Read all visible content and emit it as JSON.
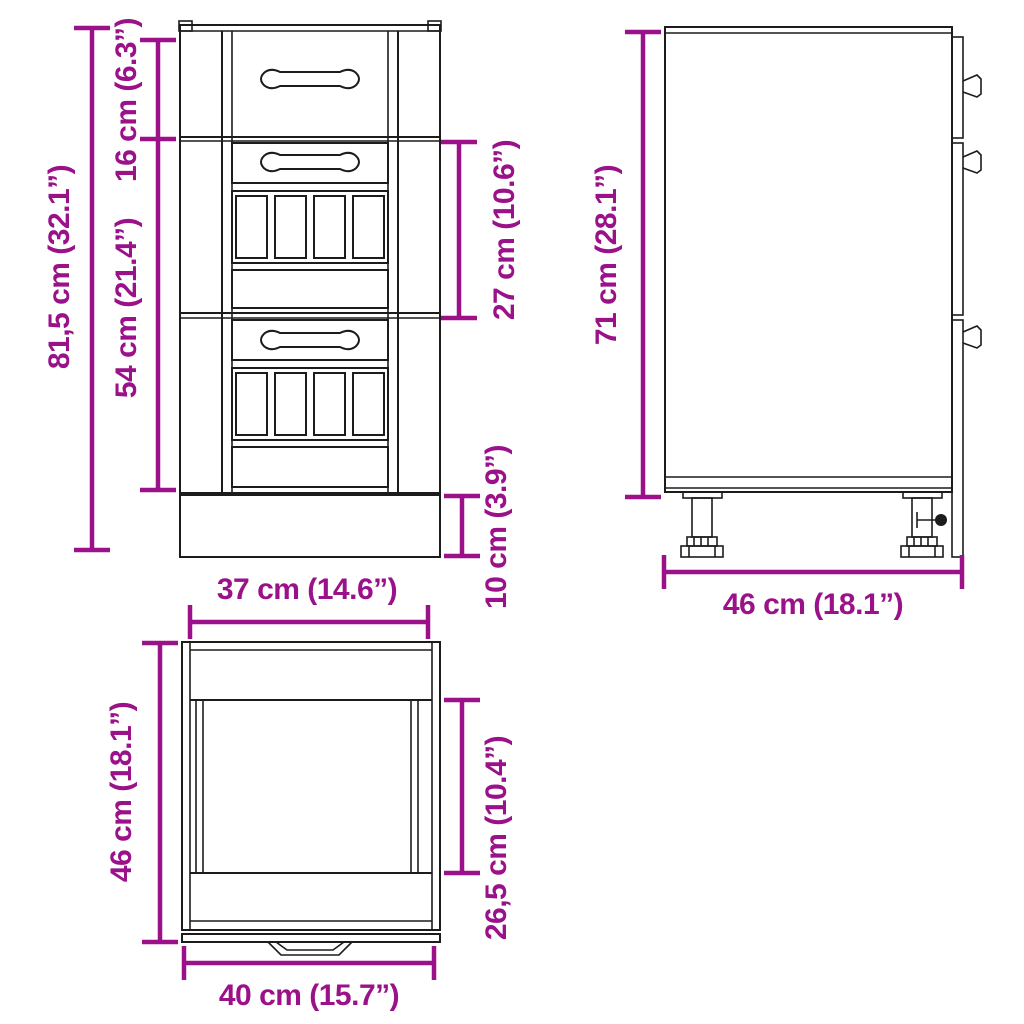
{
  "diagram": {
    "title": "Kitchen base cabinet dimension diagram",
    "colors": {
      "dimension": "#9a1189",
      "outline": "#1c1c1c",
      "background": "#ffffff"
    },
    "front_view": {
      "dim_total_height": "81,5 cm (32.1”)",
      "dim_top_drawer_height": "16 cm (6.3”)",
      "dim_drawer_stack_height": "54 cm (21.4”)",
      "dim_middle_section_height": "27 cm (10.6”)",
      "dim_plinth_height": "10 cm (3.9”)",
      "dim_front_width": "37 cm (14.6”)"
    },
    "side_view": {
      "dim_body_height": "71 cm (28.1”)",
      "dim_depth": "46 cm (18.1”)"
    },
    "top_view": {
      "dim_depth": "46 cm (18.1”)",
      "dim_inner_depth": "26,5 cm (10.4”)",
      "dim_width": "40 cm (15.7”)"
    }
  }
}
